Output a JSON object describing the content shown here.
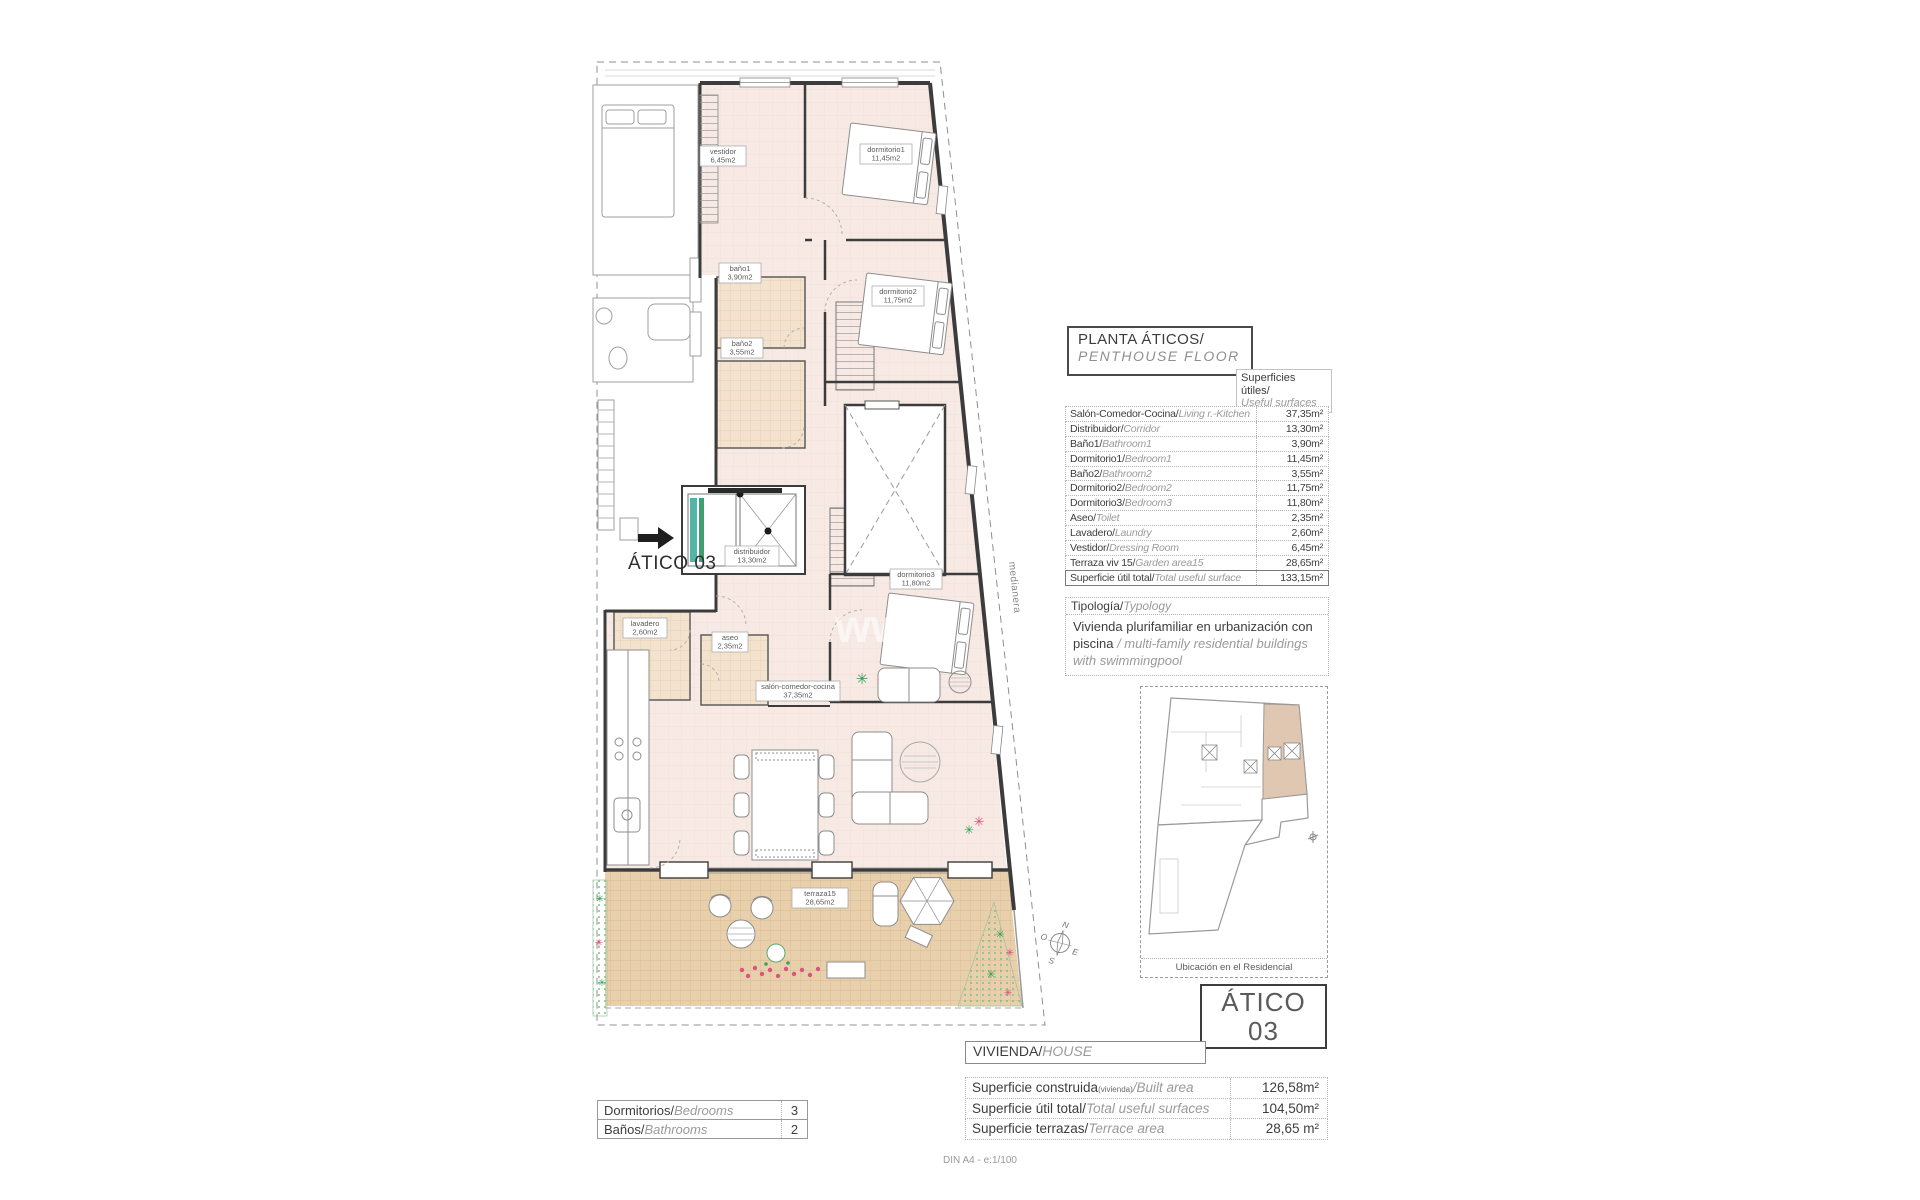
{
  "colors": {
    "floor_pink": "#f7eae4",
    "tile_tan": "#e9d0ad",
    "bath_tan": "#f3e2cd",
    "wall": "#3c3c3c",
    "elevator_teal": "#52b5a8",
    "elevator_green": "#3f9f72",
    "plant_green": "#2f9e55",
    "flower_pink": "#d9487a"
  },
  "floor_plan": {
    "unit_label": "ÁTICO 03",
    "medianera_label": "medianera",
    "watermark": "www.",
    "compass": {
      "n": "N",
      "s": "S",
      "e": "E",
      "o": "O"
    },
    "rooms": {
      "vestidor": {
        "name": "vestidor",
        "area": "6,45m2"
      },
      "dormitorio1": {
        "name": "dormitorio1",
        "area": "11,45m2"
      },
      "bano1": {
        "name": "baño1",
        "area": "3,90m2"
      },
      "bano2": {
        "name": "baño2",
        "area": "3,55m2"
      },
      "dormitorio2": {
        "name": "dormitorio2",
        "area": "11,75m2"
      },
      "distribuidor": {
        "name": "distribuidor",
        "area": "13,30m2"
      },
      "dormitorio3": {
        "name": "dormitorio3",
        "area": "11,80m2"
      },
      "lavadero": {
        "name": "lavadero",
        "area": "2,60m2"
      },
      "aseo": {
        "name": "aseo",
        "area": "2,35m2"
      },
      "salon": {
        "name": "salón-comedor-cocina",
        "area": "37,35m2"
      },
      "terraza": {
        "name": "terraza15",
        "area": "28,65m2"
      }
    }
  },
  "panel": {
    "title": "PLANTA ÁTICOS/",
    "title_en": "PENTHOUSE FLOOR",
    "surfaces_header": "Superficies útiles/",
    "surfaces_header_en": "Useful surfaces",
    "surfaces": [
      {
        "label": "Salón-Comedor-Cocina/",
        "label_en": "Living r.-Kitchen",
        "value": "37,35m²"
      },
      {
        "label": "Distribuidor/",
        "label_en": "Corridor",
        "value": "13,30m²"
      },
      {
        "label": "Baño1/",
        "label_en": "Bathroom1",
        "value": "3,90m²"
      },
      {
        "label": "Dormitorio1/",
        "label_en": "Bedroom1",
        "value": "11,45m²"
      },
      {
        "label": "Baño2/",
        "label_en": "Bathroom2",
        "value": "3,55m²"
      },
      {
        "label": "Dormitorio2/",
        "label_en": "Bedroom2",
        "value": "11,75m²"
      },
      {
        "label": "Dormitorio3/",
        "label_en": "Bedroom3",
        "value": "11,80m²"
      },
      {
        "label": "Aseo/",
        "label_en": "Toilet",
        "value": "2,35m²"
      },
      {
        "label": "Lavadero/",
        "label_en": "Laundry",
        "value": "2,60m²"
      },
      {
        "label": "Vestidor/",
        "label_en": "Dressing Room",
        "value": "6,45m²"
      },
      {
        "label": "Terraza viv 15/",
        "label_en": "Garden area15",
        "value": "28,65m²"
      }
    ],
    "total": {
      "label": "Superficie útil total/",
      "label_en": "Total useful surface",
      "value": "133,15m²"
    },
    "typology_header": "Tipología/",
    "typology_header_en": "Typology",
    "typology_es": "Vivienda plurifamiliar en urbanización con piscina ",
    "typology_en": "/ multi-family residential buildings with swimmingpool",
    "location_caption": "Ubicación en el Residencial",
    "unit_box": {
      "line1": "ÁTICO",
      "line2": "03"
    },
    "vivienda_header": "VIVIENDA/",
    "vivienda_header_en": "HOUSE",
    "house_rows": [
      {
        "label": "Superficie construida",
        "sub": "(vivienda)",
        "label_en": "/Built area",
        "value": "126,58m²"
      },
      {
        "label": "Superficie útil total/",
        "sub": "",
        "label_en": "Total useful surfaces",
        "value": "104,50m²"
      },
      {
        "label": "Superficie terrazas/",
        "sub": "",
        "label_en": "Terrace area",
        "value": "28,65 m²"
      }
    ],
    "rooms_table": [
      {
        "label": "Dormitorios/",
        "label_en": "Bedrooms",
        "value": "3"
      },
      {
        "label": "Baños/",
        "label_en": "Bathrooms",
        "value": "2"
      }
    ],
    "footer": "DIN A4 - e:1/100"
  }
}
